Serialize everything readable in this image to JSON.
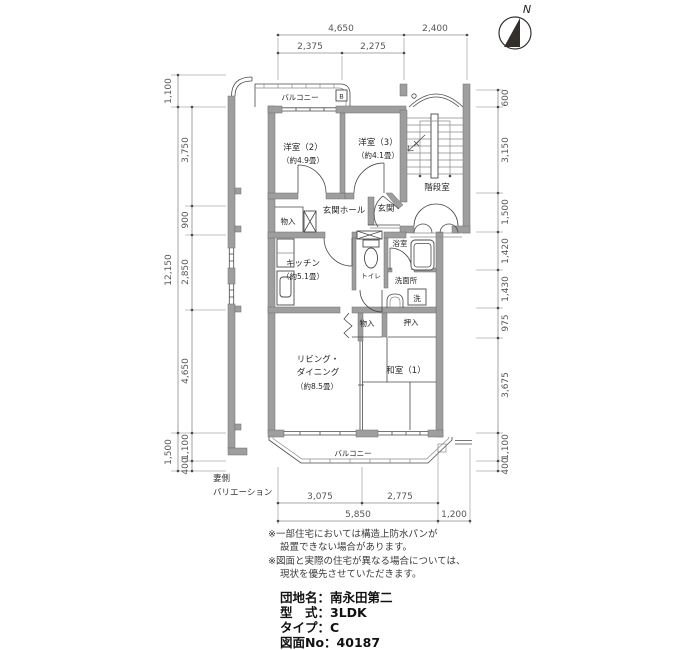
{
  "compass": {
    "north": "N"
  },
  "dims": {
    "top_row1": [
      "4,650",
      "2,400"
    ],
    "top_row2": [
      "2,375",
      "2,275"
    ],
    "left_outer": [
      "1,100",
      "12,150",
      "1,500"
    ],
    "left_inner": [
      "3,750",
      "900",
      "2,850",
      "4,650",
      "1,100",
      "400"
    ],
    "right": [
      "600",
      "3,150",
      "1,500",
      "1,420",
      "1,430",
      "975",
      "3,675",
      "1,100",
      "400"
    ],
    "bottom_row1": [
      "3,075",
      "2,775"
    ],
    "bottom_row2": [
      "5,850",
      "1,200"
    ]
  },
  "rooms": {
    "balcony_top": "バルコニー",
    "balcony_marker": "B",
    "western2": "洋室（2）",
    "western2_size": "（約4.9畳）",
    "western3": "洋室（3）",
    "western3_size": "（約4.1畳）",
    "stairwell": "階段室",
    "entrance_hall": "玄関ホール",
    "entrance": "玄関",
    "storage_top": "物入",
    "kitchen": "キッチン",
    "kitchen_size": "（約5.1畳）",
    "toilet": "トイレ",
    "bath": "浴室",
    "washroom": "洗面所",
    "washer": "洗",
    "storage_mid": "物入",
    "closet": "押入",
    "living1": "リビング・",
    "living2": "ダイニング",
    "living_size": "（約8.5畳）",
    "japanese_room": "和室（1）",
    "balcony_bottom": "バルコニー"
  },
  "side_annotation": {
    "line1": "妻側",
    "line2": "バリエーション"
  },
  "notes": [
    "※一部住宅においては構造上防水パンが",
    "設置できない場合があります。",
    "※図面と実際の住宅が異なる場合については、",
    "現状を優先させていただきます。"
  ],
  "info": [
    "団地名：南永田第二",
    "型　式：3LDK",
    "タイプ：C",
    "図面No：40187"
  ],
  "colors": {
    "wall": "#9e9e9e",
    "line": "#4a4a4a",
    "dim_text": "#575757",
    "compass": "#33302b"
  }
}
